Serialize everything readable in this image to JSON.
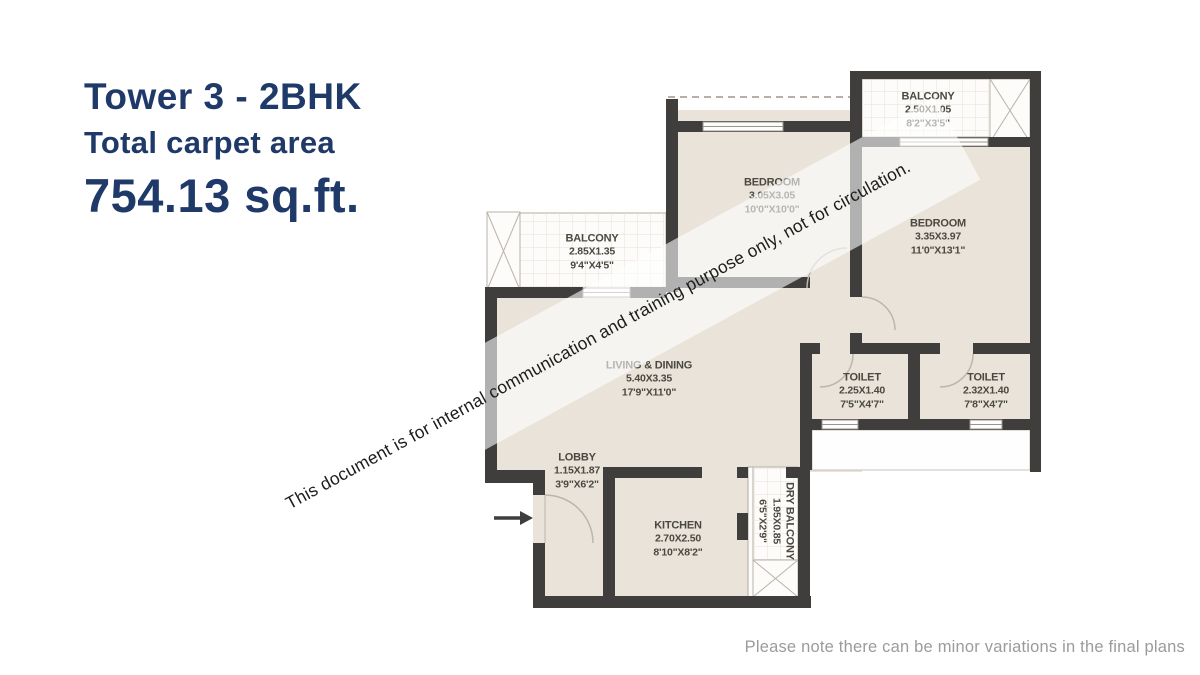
{
  "title": {
    "line1": "Tower 3 - 2BHK",
    "line2": "Total carpet area",
    "line3": "754.13 sq.ft.",
    "color": "#1f3a68"
  },
  "watermark": {
    "text": "This document is for internal communication and training purpose only, not for circulation."
  },
  "footer": {
    "note": "Please note there can be minor variations in the final plans"
  },
  "floor_plan": {
    "colors": {
      "wall": "#3f3e3c",
      "room_fill": "#e9e3d9",
      "balcony_fill": "#fdfcfa",
      "line": "#9a958c"
    },
    "rooms": {
      "balcony_left": {
        "name": "BALCONY",
        "metric": "2.85X1.35",
        "imperial": "9'4\"X4'5\""
      },
      "balcony_top": {
        "name": "BALCONY",
        "metric": "2.50X1.05",
        "imperial": "8'2\"X3'5\""
      },
      "bedroom_top": {
        "name": "BEDROOM",
        "metric": "3.05X3.05",
        "imperial": "10'0\"X10'0\""
      },
      "bedroom_right": {
        "name": "BEDROOM",
        "metric": "3.35X3.97",
        "imperial": "11'0\"X13'1\""
      },
      "living_dining": {
        "name": "LIVING & DINING",
        "metric": "5.40X3.35",
        "imperial": "17'9\"X11'0\""
      },
      "lobby": {
        "name": "LOBBY",
        "metric": "1.15X1.87",
        "imperial": "3'9\"X6'2\""
      },
      "kitchen": {
        "name": "KITCHEN",
        "metric": "2.70X2.50",
        "imperial": "8'10\"X8'2\""
      },
      "toilet_left": {
        "name": "TOILET",
        "metric": "2.25X1.40",
        "imperial": "7'5\"X4'7\""
      },
      "toilet_right": {
        "name": "TOILET",
        "metric": "2.32X1.40",
        "imperial": "7'8\"X4'7\""
      },
      "dry_balcony": {
        "name": "DRY BALCONY",
        "metric": "1.95X0.85",
        "imperial": "6'5\"X2'9\""
      }
    }
  }
}
